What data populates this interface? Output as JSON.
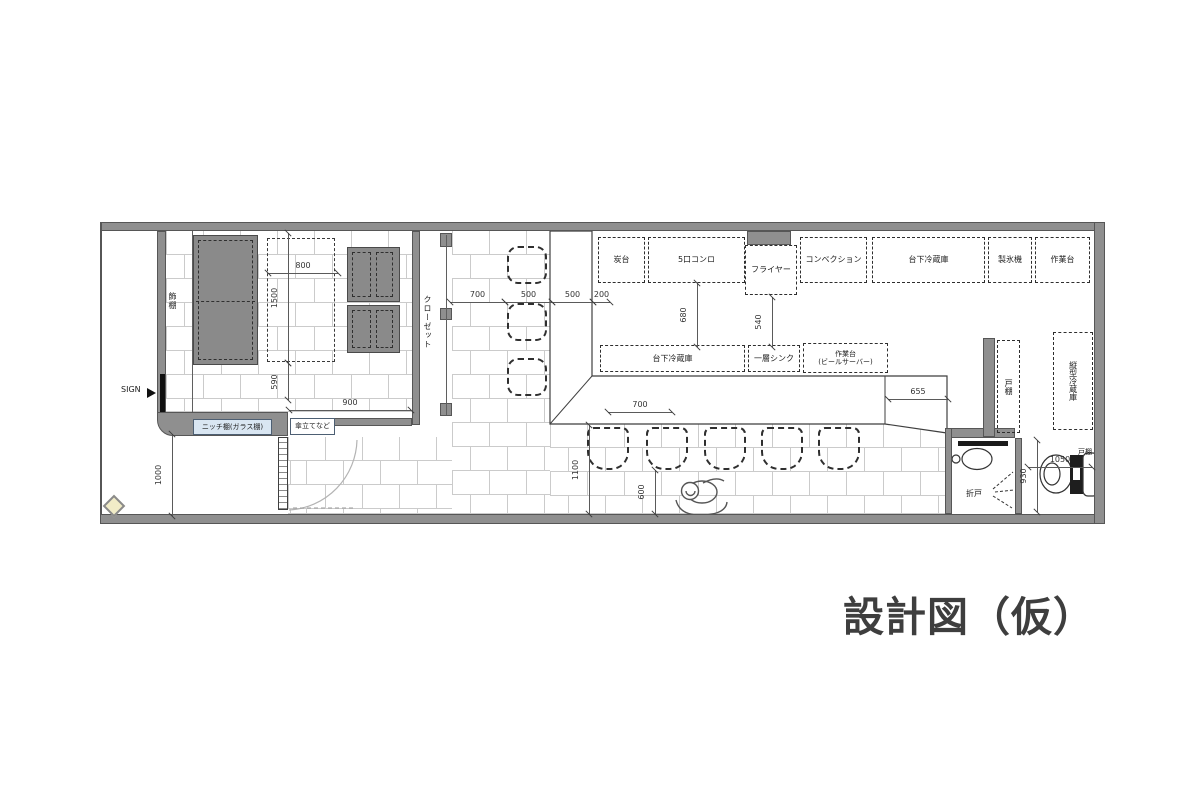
{
  "title": "設計図（仮）",
  "colors": {
    "wall": "#8f8f8f",
    "wall_outline": "#565656",
    "tile_line": "#cbcbcb",
    "table_fill": "#8a8a8a",
    "dash": "#2e2e2e",
    "dim": "#5a5a5a",
    "niche_bg": "#d9e6f2",
    "sign_black": "#101010",
    "diamond_fill": "#f1ecc7",
    "title_color": "#3e3e3e"
  },
  "walls": [
    {
      "id": "top-wall",
      "x": 100,
      "y": 222,
      "w": 1005,
      "h": 9
    },
    {
      "id": "bottom-wall",
      "x": 100,
      "y": 514,
      "w": 1005,
      "h": 10
    },
    {
      "id": "right-wall",
      "x": 1094,
      "y": 222,
      "w": 11,
      "h": 302
    },
    {
      "id": "left-boundary",
      "x": 100,
      "y": 222,
      "w": 2,
      "h": 292
    },
    {
      "id": "sign-wall",
      "x": 157,
      "y": 231,
      "w": 9,
      "h": 182
    },
    {
      "id": "entry-wall-band",
      "x": 157,
      "y": 412,
      "w": 131,
      "h": 24,
      "r": "0 0 0 16px"
    },
    {
      "id": "fryer-recess",
      "x": 747,
      "y": 231,
      "w": 44,
      "h": 14
    },
    {
      "id": "closet-left-wall",
      "x": 412,
      "y": 231,
      "w": 8,
      "h": 194
    },
    {
      "id": "entry-front-bar",
      "x": 332,
      "y": 418,
      "w": 80,
      "h": 8
    },
    {
      "id": "washroom-top-wall",
      "x": 945,
      "y": 428,
      "w": 70,
      "h": 10
    },
    {
      "id": "washroom-left-wall",
      "x": 945,
      "y": 428,
      "w": 7,
      "h": 86
    },
    {
      "id": "rooms-divider-wall",
      "x": 1015,
      "y": 438,
      "w": 7,
      "h": 76
    },
    {
      "id": "cupboard-wall",
      "x": 983,
      "y": 338,
      "w": 12,
      "h": 99
    },
    {
      "id": "closet-block-top",
      "x": 440,
      "y": 233,
      "w": 12,
      "h": 14
    },
    {
      "id": "closet-block-mid",
      "x": 440,
      "y": 308,
      "w": 12,
      "h": 12
    },
    {
      "id": "closet-block-bottom",
      "x": 440,
      "y": 403,
      "w": 12,
      "h": 13
    }
  ],
  "thin_lines": [
    {
      "id": "shelf-strip-line",
      "x": 192,
      "y": 231,
      "w": 1,
      "h": 181
    },
    {
      "id": "closet-door-line",
      "x": 446,
      "y": 235,
      "w": 1,
      "h": 180
    },
    {
      "id": "basin-counter-bar",
      "x": 958,
      "y": 441,
      "w": 50,
      "h": 5,
      "color": "#1a1a1a"
    },
    {
      "id": "sign-bar",
      "x": 160,
      "y": 374,
      "w": 5,
      "h": 38,
      "color": "#101010"
    }
  ],
  "tile_regions": [
    {
      "id": "seating-room-floor",
      "x": 166,
      "y": 231,
      "w": 246,
      "h": 181
    },
    {
      "id": "corridor-floor",
      "x": 452,
      "y": 231,
      "w": 98,
      "h": 283
    },
    {
      "id": "entry-floor",
      "x": 288,
      "y": 437,
      "w": 164,
      "h": 77
    },
    {
      "id": "dining-floor",
      "x": 550,
      "y": 424,
      "w": 395,
      "h": 90
    }
  ],
  "tables": [
    {
      "id": "large-table",
      "x": 193,
      "y": 235,
      "w": 65,
      "h": 130,
      "type": "dark-split"
    },
    {
      "id": "reserved-space",
      "x": 267,
      "y": 238,
      "w": 68,
      "h": 124,
      "type": "dashed"
    },
    {
      "id": "table-2",
      "x": 347,
      "y": 247,
      "w": 53,
      "h": 55,
      "type": "dark-cols"
    },
    {
      "id": "table-3",
      "x": 347,
      "y": 305,
      "w": 53,
      "h": 48,
      "type": "dark-cols"
    }
  ],
  "chairs": {
    "corridor": [
      {
        "x": 507,
        "y": 246
      },
      {
        "x": 507,
        "y": 303
      },
      {
        "x": 507,
        "y": 358
      }
    ],
    "counter": [
      {
        "x": 587,
        "y": 427
      },
      {
        "x": 646,
        "y": 427
      },
      {
        "x": 704,
        "y": 427
      },
      {
        "x": 761,
        "y": 427
      },
      {
        "x": 818,
        "y": 427
      }
    ],
    "corridor_size": {
      "w": 40,
      "h": 38
    },
    "counter_size": {
      "w": 42,
      "h": 43
    }
  },
  "equipment": [
    {
      "text": "炭台",
      "x": 598,
      "y": 237,
      "w": 47,
      "h": 46
    },
    {
      "text": "5口コンロ",
      "x": 648,
      "y": 237,
      "w": 97,
      "h": 46
    },
    {
      "text": "フライヤー",
      "x": 745,
      "y": 245,
      "w": 52,
      "h": 50
    },
    {
      "text": "コンベクション",
      "x": 800,
      "y": 237,
      "w": 67,
      "h": 46
    },
    {
      "text": "台下冷蔵庫",
      "x": 872,
      "y": 237,
      "w": 113,
      "h": 46
    },
    {
      "text": "製氷機",
      "x": 988,
      "y": 237,
      "w": 44,
      "h": 46
    },
    {
      "text": "作業台",
      "x": 1035,
      "y": 237,
      "w": 55,
      "h": 46
    },
    {
      "text": "台下冷蔵庫",
      "x": 600,
      "y": 345,
      "w": 145,
      "h": 27
    },
    {
      "text": "一層シンク",
      "x": 748,
      "y": 345,
      "w": 52,
      "h": 27
    },
    {
      "text": "作業台\n(ビールサーバー)",
      "x": 803,
      "y": 343,
      "w": 85,
      "h": 30,
      "fs": 7
    },
    {
      "text": "戸棚",
      "x": 997,
      "y": 340,
      "w": 23,
      "h": 93,
      "vertical": true
    },
    {
      "text": "縦型冷蔵庫",
      "x": 1053,
      "y": 332,
      "w": 40,
      "h": 98,
      "vertical": true
    }
  ],
  "labels": [
    {
      "id": "sign-label",
      "text": "SIGN",
      "x": 121,
      "y": 386,
      "fs": 8
    },
    {
      "id": "shelf-label",
      "text": "飾棚",
      "x": 168,
      "y": 292,
      "fs": 8,
      "vertical": true
    },
    {
      "id": "closet-label",
      "text": "クローゼット",
      "x": 423,
      "y": 295,
      "fs": 8,
      "vertical": true
    },
    {
      "id": "niche-label",
      "text": "ニッチ棚(ガラス棚)",
      "x": 193,
      "y": 419,
      "w": 77,
      "h": 14,
      "fs": 7,
      "boxed": true,
      "bg": "#d9e6f2"
    },
    {
      "id": "umbrella-label",
      "text": "傘立てなど",
      "x": 290,
      "y": 418,
      "w": 43,
      "h": 15,
      "fs": 7,
      "boxed": true,
      "bg": "#ffffff"
    },
    {
      "id": "folding-door-label",
      "text": "折戸",
      "x": 966,
      "y": 490,
      "fs": 8
    },
    {
      "id": "toilet-cupboard-label",
      "text": "戸棚",
      "x": 1078,
      "y": 449,
      "fs": 7
    }
  ],
  "dimensions_h": [
    {
      "text": "800",
      "x": 268,
      "y": 273,
      "len": 70
    },
    {
      "text": "900",
      "x": 289,
      "y": 410,
      "len": 122
    },
    {
      "text": "700",
      "x": 450,
      "y": 302,
      "len": 55
    },
    {
      "text": "500",
      "x": 505,
      "y": 302,
      "len": 47
    },
    {
      "text": "500",
      "x": 552,
      "y": 302,
      "len": 41
    },
    {
      "text": "200",
      "x": 593,
      "y": 302,
      "len": 17
    },
    {
      "text": "655",
      "x": 888,
      "y": 399,
      "len": 60
    },
    {
      "text": "700",
      "x": 608,
      "y": 412,
      "len": 64
    },
    {
      "text": "1050",
      "x": 1028,
      "y": 467,
      "len": 64
    }
  ],
  "dimensions_v": [
    {
      "text": "1500",
      "x": 288,
      "y": 233,
      "len": 130
    },
    {
      "text": "590",
      "x": 288,
      "y": 363,
      "len": 37
    },
    {
      "text": "1000",
      "x": 172,
      "y": 434,
      "len": 82
    },
    {
      "text": "680",
      "x": 697,
      "y": 283,
      "len": 64
    },
    {
      "text": "540",
      "x": 772,
      "y": 297,
      "len": 50
    },
    {
      "text": "1100",
      "x": 589,
      "y": 425,
      "len": 89
    },
    {
      "text": "600",
      "x": 655,
      "y": 470,
      "len": 44
    },
    {
      "text": "930",
      "x": 1037,
      "y": 440,
      "len": 72
    }
  ]
}
